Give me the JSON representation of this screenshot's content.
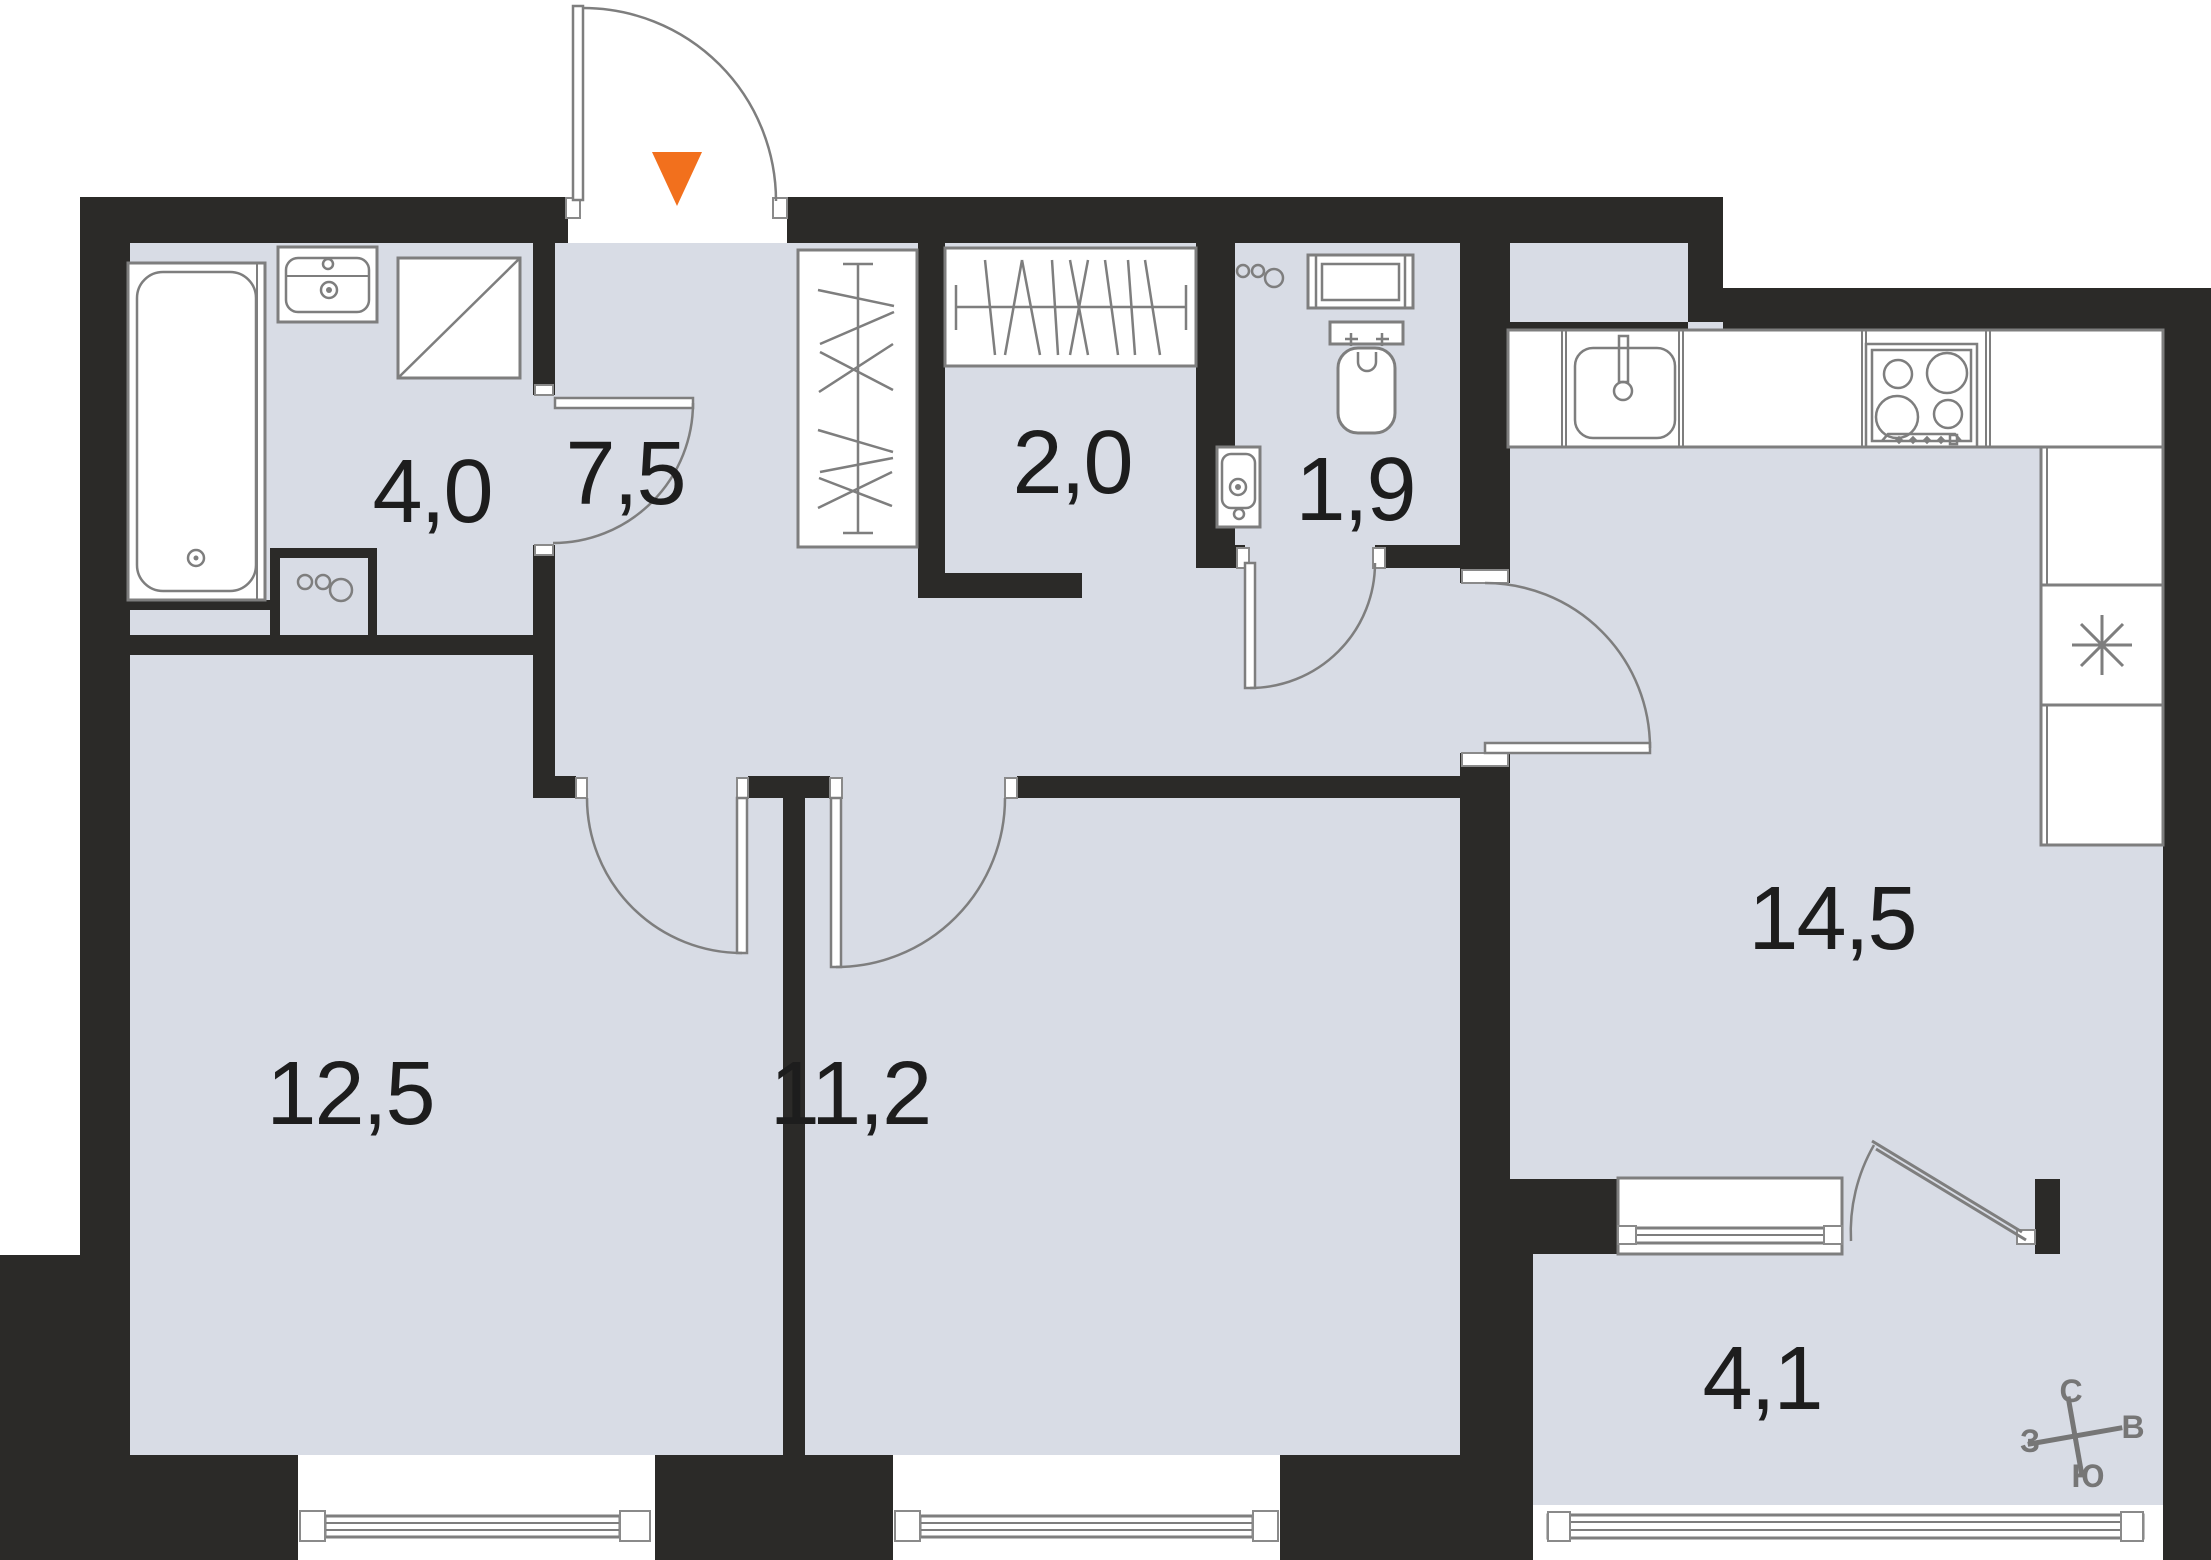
{
  "floorplan": {
    "title": "apartment-floor-plan",
    "rooms": [
      {
        "id": "bathroom",
        "area": "4,0"
      },
      {
        "id": "closet",
        "area": "2,0"
      },
      {
        "id": "wc",
        "area": "1,9"
      },
      {
        "id": "hallway",
        "area": "7,5"
      },
      {
        "id": "bedroom-1",
        "area": "12,5"
      },
      {
        "id": "bedroom-2",
        "area": "11,2"
      },
      {
        "id": "kitchen-living",
        "area": "14,5"
      },
      {
        "id": "balcony",
        "area": "4,1"
      }
    ],
    "compass": {
      "north": "С",
      "east": "В",
      "south": "Ю",
      "west": "З"
    },
    "icons": [
      "entrance-marker-icon",
      "bathtub-icon",
      "bath-sink-icon",
      "washing-machine-icon",
      "riser-pipes-icon",
      "wardrobe-icon",
      "closet-rail-icon",
      "towel-radiator-icon",
      "toilet-icon",
      "wc-basin-icon",
      "kitchen-sink-icon",
      "stove-icon",
      "fridge-icon",
      "compass-rose-icon",
      "window-icon",
      "door-swing-icon"
    ],
    "colors": {
      "wall": "#2b2a28",
      "floor": "#d8dce5",
      "outline": "#7e7e7e",
      "entrance_marker": "#f2701d",
      "background": "#ffffff"
    }
  }
}
